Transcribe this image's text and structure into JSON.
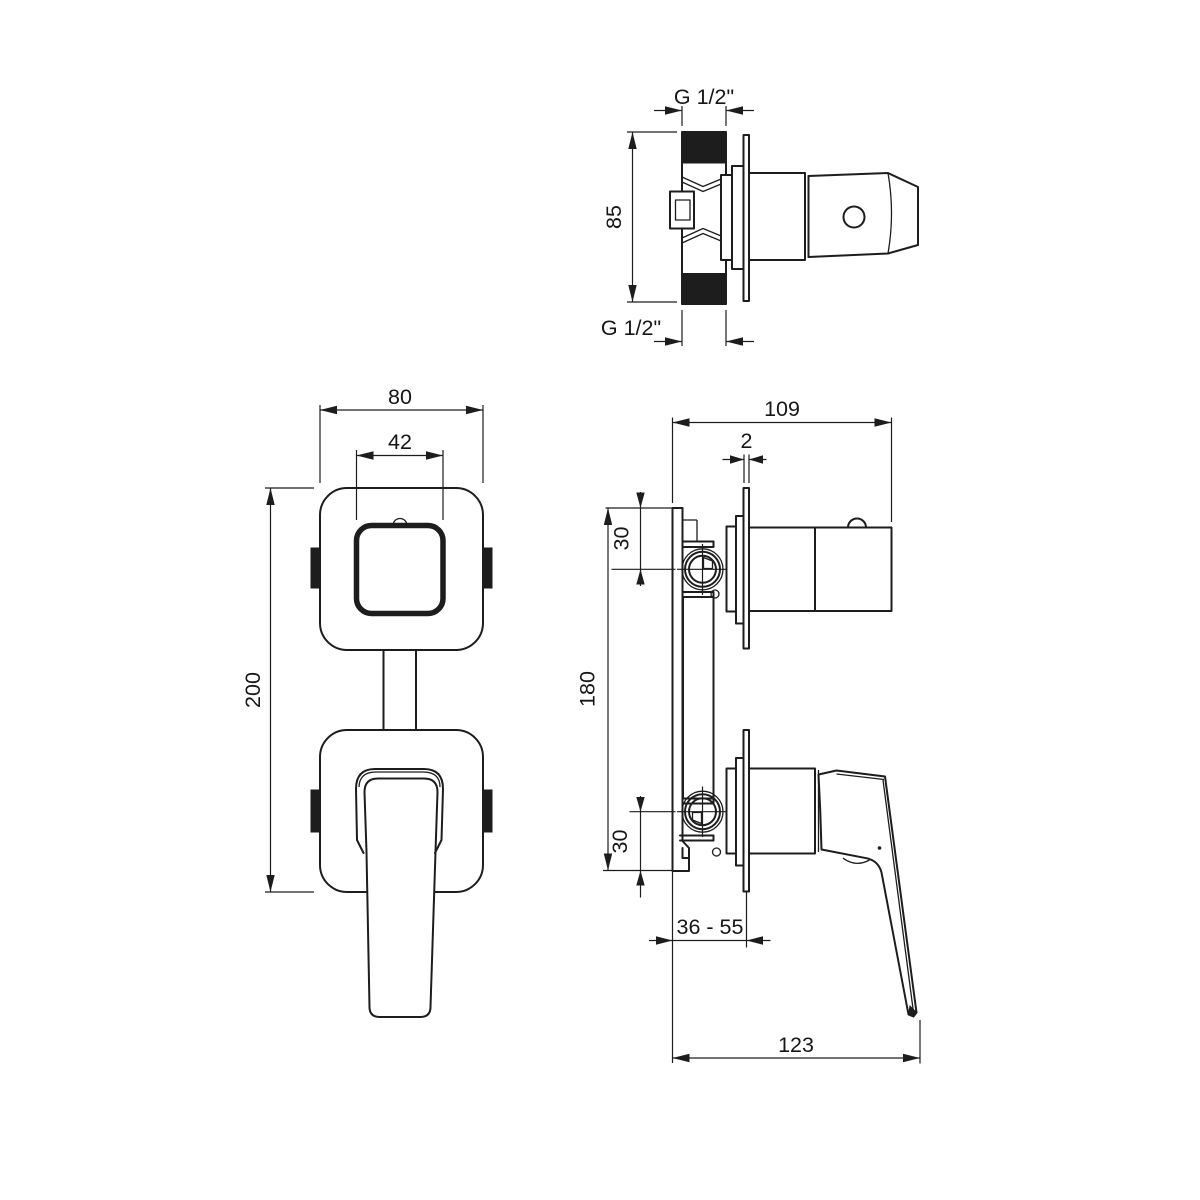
{
  "drawing": {
    "background": "#ffffff",
    "line_color": "#1d1d1d",
    "views": {
      "valve_top": {
        "thread_top": "G 1/2\"",
        "height": "85",
        "thread_bottom": "G 1/2\""
      },
      "front": {
        "plate_width": "80",
        "knob_width": "42",
        "total_height": "200"
      },
      "side": {
        "depth": "109",
        "plate_thickness": "2",
        "top_offset": "30",
        "valve_spacing": "180",
        "bottom_offset": "30",
        "wall_range": "36 - 55",
        "handle_reach": "123"
      }
    }
  }
}
